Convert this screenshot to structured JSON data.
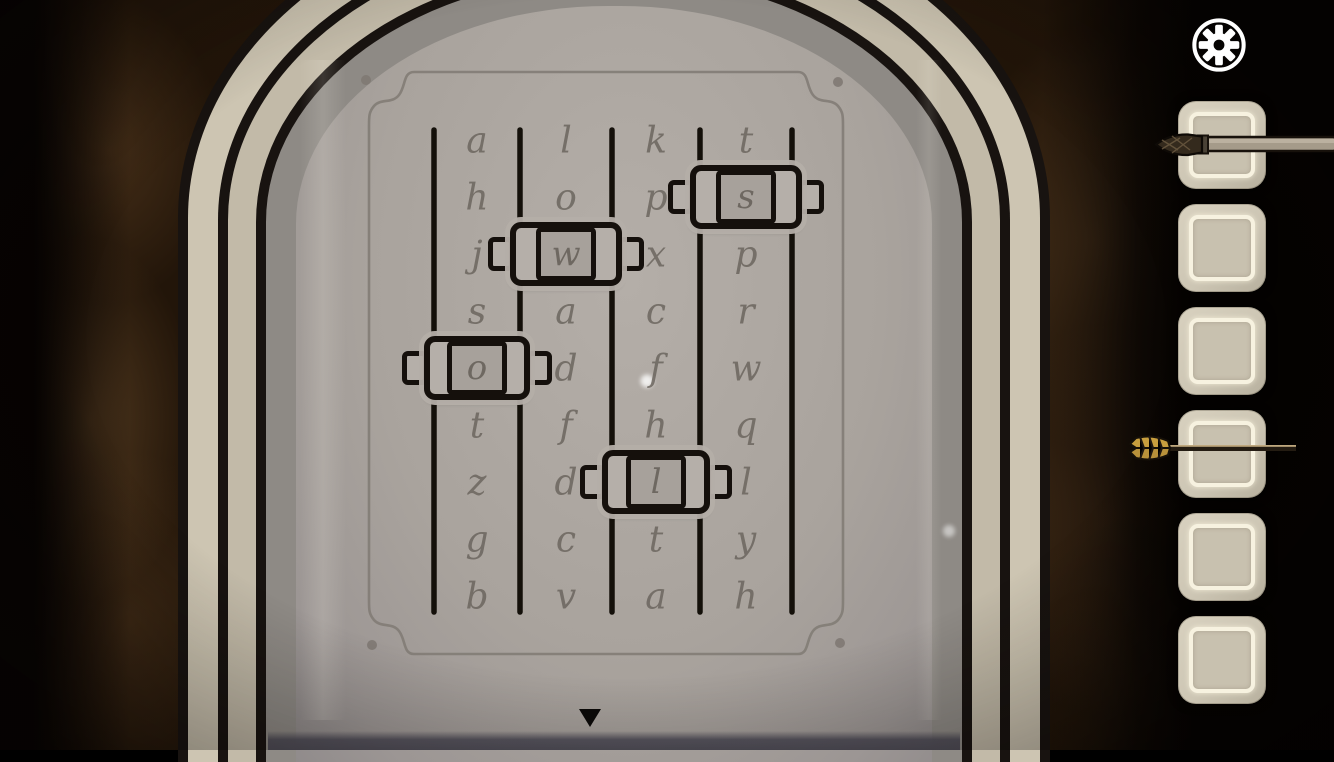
{
  "scene": "stone-door-letter-slider-puzzle",
  "hud": {
    "settings_button": {
      "icon": "gear-icon"
    },
    "nav_down_button": {
      "icon": "triangle-down-icon",
      "symbol": "▼"
    }
  },
  "puzzle": {
    "rail_count": 5,
    "columns": [
      {
        "letters": [
          "a",
          "h",
          "j",
          "s",
          "o",
          "t",
          "z",
          "g",
          "b"
        ],
        "slider_index": 4,
        "selected_letter": "o"
      },
      {
        "letters": [
          "l",
          "o",
          "w",
          "a",
          "d",
          "f",
          "d",
          "c",
          "v"
        ],
        "slider_index": 2,
        "selected_letter": "w"
      },
      {
        "letters": [
          "k",
          "p",
          "x",
          "c",
          "f",
          "h",
          "l",
          "t",
          "a"
        ],
        "slider_index": 6,
        "selected_letter": "l"
      },
      {
        "letters": [
          "t",
          "s",
          "p",
          "r",
          "w",
          "q",
          "l",
          "y",
          "h"
        ],
        "slider_index": 1,
        "selected_letter": "s"
      }
    ],
    "selected_word": "owls"
  },
  "inventory": {
    "slot_count": 6,
    "slots": [
      {
        "item": "paintbrush"
      },
      {
        "item": null
      },
      {
        "item": null
      },
      {
        "item": "arrow"
      },
      {
        "item": null
      },
      {
        "item": null
      }
    ]
  },
  "colors": {
    "background_brown": "#4c3723",
    "stone_face": "#aaa49e",
    "band_cream": "#cdc5b2",
    "band_tan": "#c2baa8",
    "band_gray": "#8e8a85",
    "ink_outline": "#16110d",
    "letter_gray": "#6b655e",
    "plaque_line": "#827c76",
    "slot_beige": "#d2cbb9",
    "slot_ring": "#f7f2e0",
    "fletching_gold": "#c79e3e",
    "icon_white": "#ffffff"
  }
}
